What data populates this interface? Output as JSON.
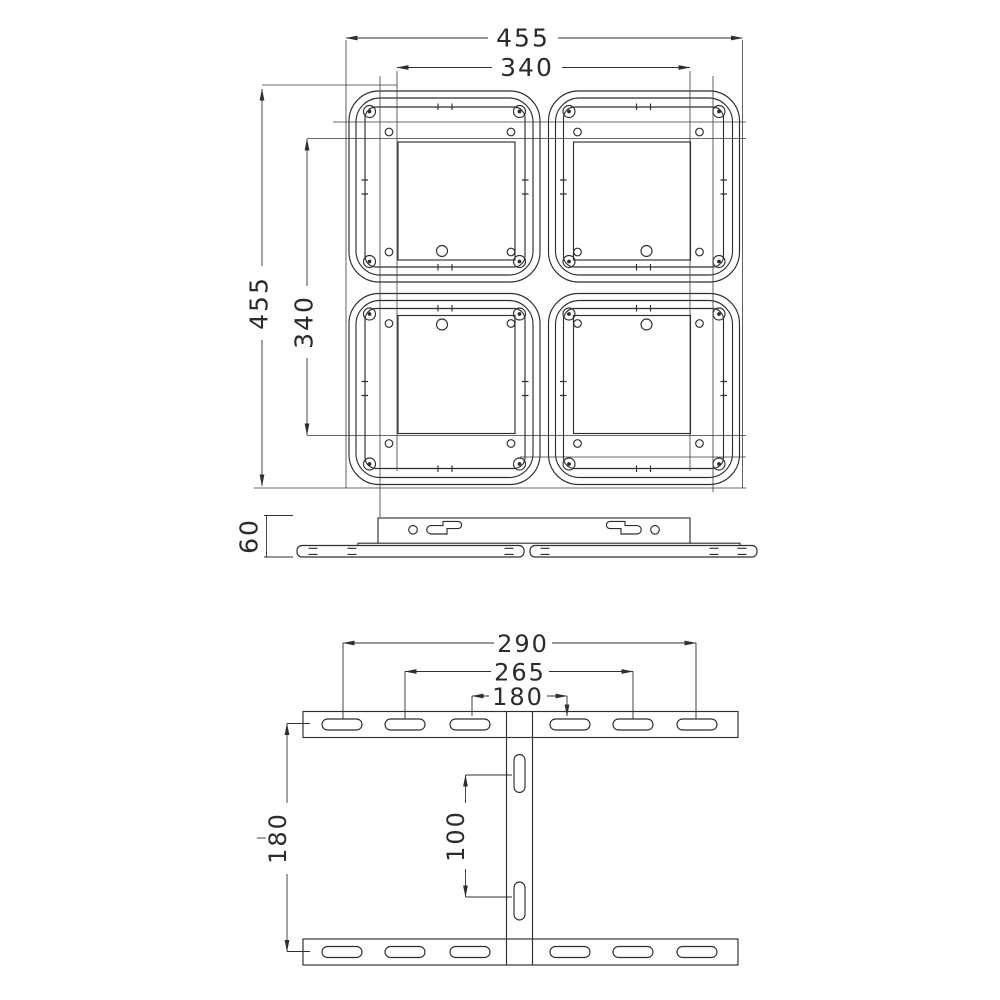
{
  "drawing": {
    "type": "technical-drawing",
    "line_color": "#2e2e2e",
    "background": "#ffffff"
  },
  "top_view": {
    "outer_width": "455",
    "inner_width": "340",
    "outer_height": "455",
    "inner_height": "340",
    "modules": 4
  },
  "side_view": {
    "thickness": "60"
  },
  "front_view": {
    "hole_span_outer": "290",
    "hole_span_middle": "265",
    "hole_span_inner": "180",
    "row_spacing": "180",
    "slot_spacing": "100",
    "tick": "-",
    "top_row_slots": 6,
    "bottom_row_slots": 6,
    "column_slots": 2
  }
}
